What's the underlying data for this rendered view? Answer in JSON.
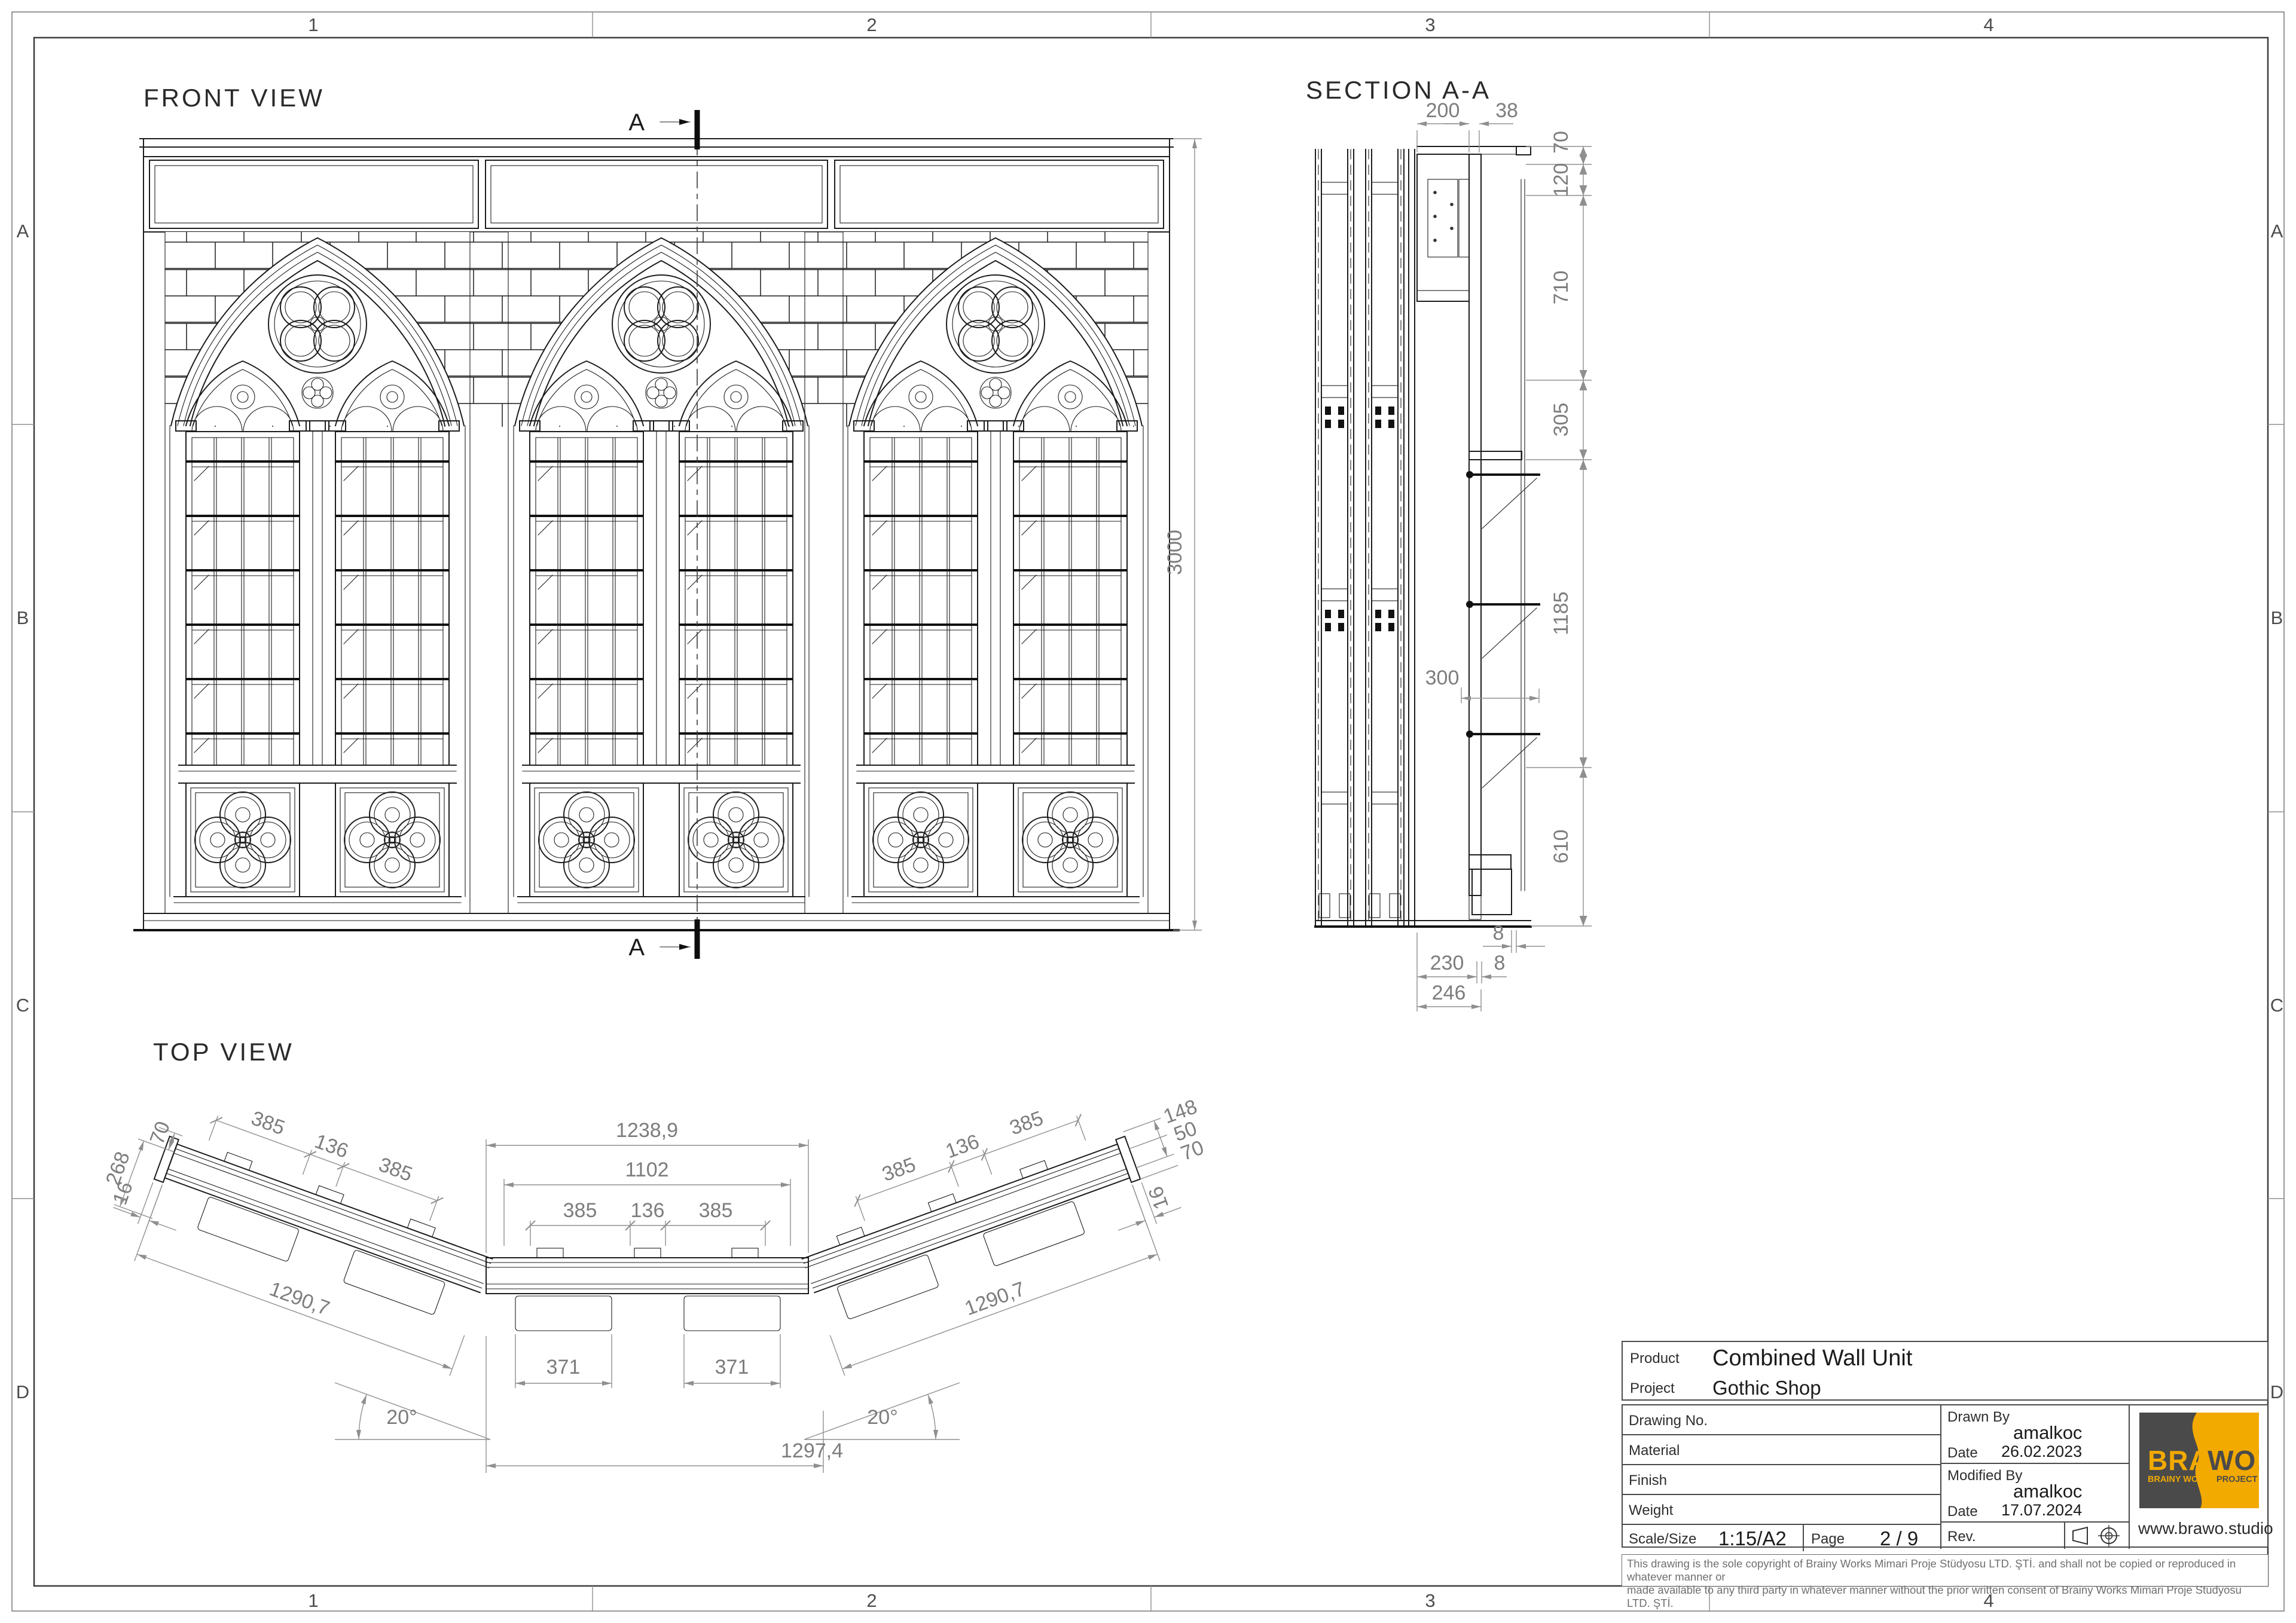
{
  "grid": {
    "cols": [
      "1",
      "2",
      "3",
      "4"
    ],
    "rows": [
      "A",
      "B",
      "C",
      "D"
    ]
  },
  "front": {
    "title": "FRONT VIEW",
    "dim_3000": "3000",
    "cut_label_top": "A",
    "cut_label_bottom": "A"
  },
  "section": {
    "title": "SECTION A-A",
    "dim_200": "200",
    "dim_38": "38",
    "dim_70": "70",
    "dim_120": "120",
    "dim_710": "710",
    "dim_305": "305",
    "dim_1185": "1185",
    "dim_610": "610",
    "dim_300": "300",
    "dim_8a": "8",
    "dim_230": "230",
    "dim_8b": "8",
    "dim_246": "246"
  },
  "top": {
    "title": "TOP VIEW",
    "left": {
      "d268": "268",
      "d70": "70",
      "d16": "16",
      "d385a": "385",
      "d136": "136",
      "d385b": "385",
      "d1290": "1290,7",
      "angle": "20°"
    },
    "center": {
      "d1238": "1238,9",
      "d1102": "1102",
      "d385a": "385",
      "d136": "136",
      "d385b": "385",
      "d371a": "371",
      "d371b": "371",
      "d1297": "1297,4"
    },
    "right": {
      "d148": "148",
      "d50": "50",
      "d70": "70",
      "d16": "16",
      "d385a": "385",
      "d136": "136",
      "d385b": "385",
      "d1290": "1290,7",
      "angle": "20°"
    }
  },
  "title_block": {
    "product_label": "Product",
    "product_value": "Combined Wall Unit",
    "project_label": "Project",
    "project_value": "Gothic Shop",
    "drawing_no_label": "Drawing No.",
    "material_label": "Material",
    "finish_label": "Finish",
    "weight_label": "Weight",
    "scale_label": "Scale/Size",
    "scale_value": "1:15/A2",
    "page_label": "Page",
    "page_value": "2 / 9",
    "rev_label": "Rev.",
    "drawn_by_label": "Drawn By",
    "drawn_by_value": "amalkoc",
    "drawn_date_label": "Date",
    "drawn_date_value": "26.02.2023",
    "modified_by_label": "Modified By",
    "modified_by_value": "amalkoc",
    "modified_date_label": "Date",
    "modified_date_value": "17.07.2024",
    "logo_line1a": "BRA",
    "logo_line1b": "WO!",
    "logo_line2a": "BRAINY WORKS",
    "logo_line2b": "PROJECT STUDIO",
    "website": "www.brawo.studio",
    "brand_yellow": "#F2A900",
    "brand_dark": "#4A4A4A",
    "disclaimer_line1": "This drawing is the sole copyright of Brainy Works Mimari Proje Stüdyosu LTD. ŞTİ. and shall not be copied or reproduced in whatever manner or",
    "disclaimer_line2": "made available to any third party in whatever manner without the prior written consent of Brainy Works Mimari Proje Stüdyosu LTD. ŞTİ."
  }
}
